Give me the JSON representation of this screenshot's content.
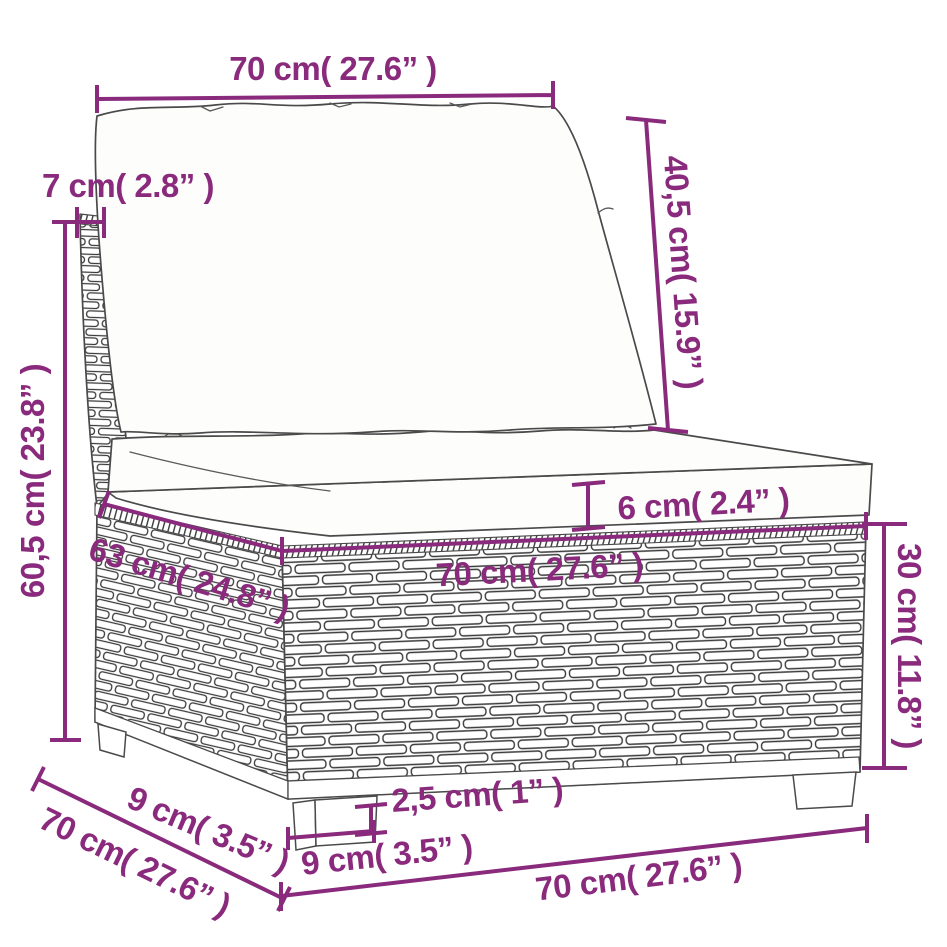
{
  "title": "Rattan sofa section dimension diagram",
  "style": {
    "dimension_color": "#8a2a7c",
    "outline_color": "#4a4a4a",
    "background": "#ffffff"
  },
  "dimensions": {
    "back_cushion_width": "70 cm( 27.6” )",
    "back_panel_top_thickness": "7 cm( 2.8” )",
    "back_cushion_height": "40,5 cm( 15.9” )",
    "total_height": "60,5 cm( 23.8” )",
    "seat_cushion_thickness": "6 cm( 2.4” )",
    "seat_depth": "63 cm( 24.8” )",
    "seat_width": "70 cm( 27.6” )",
    "base_height": "30 cm( 11.8” )",
    "leg_height": "2,5 cm( 1” )",
    "leg_width": "9 cm( 3.5” )",
    "bottom_width": "70 cm( 27.6” )",
    "leg_inset_depth": "9 cm( 3.5” )",
    "total_depth": "70 cm( 27.6” )"
  }
}
